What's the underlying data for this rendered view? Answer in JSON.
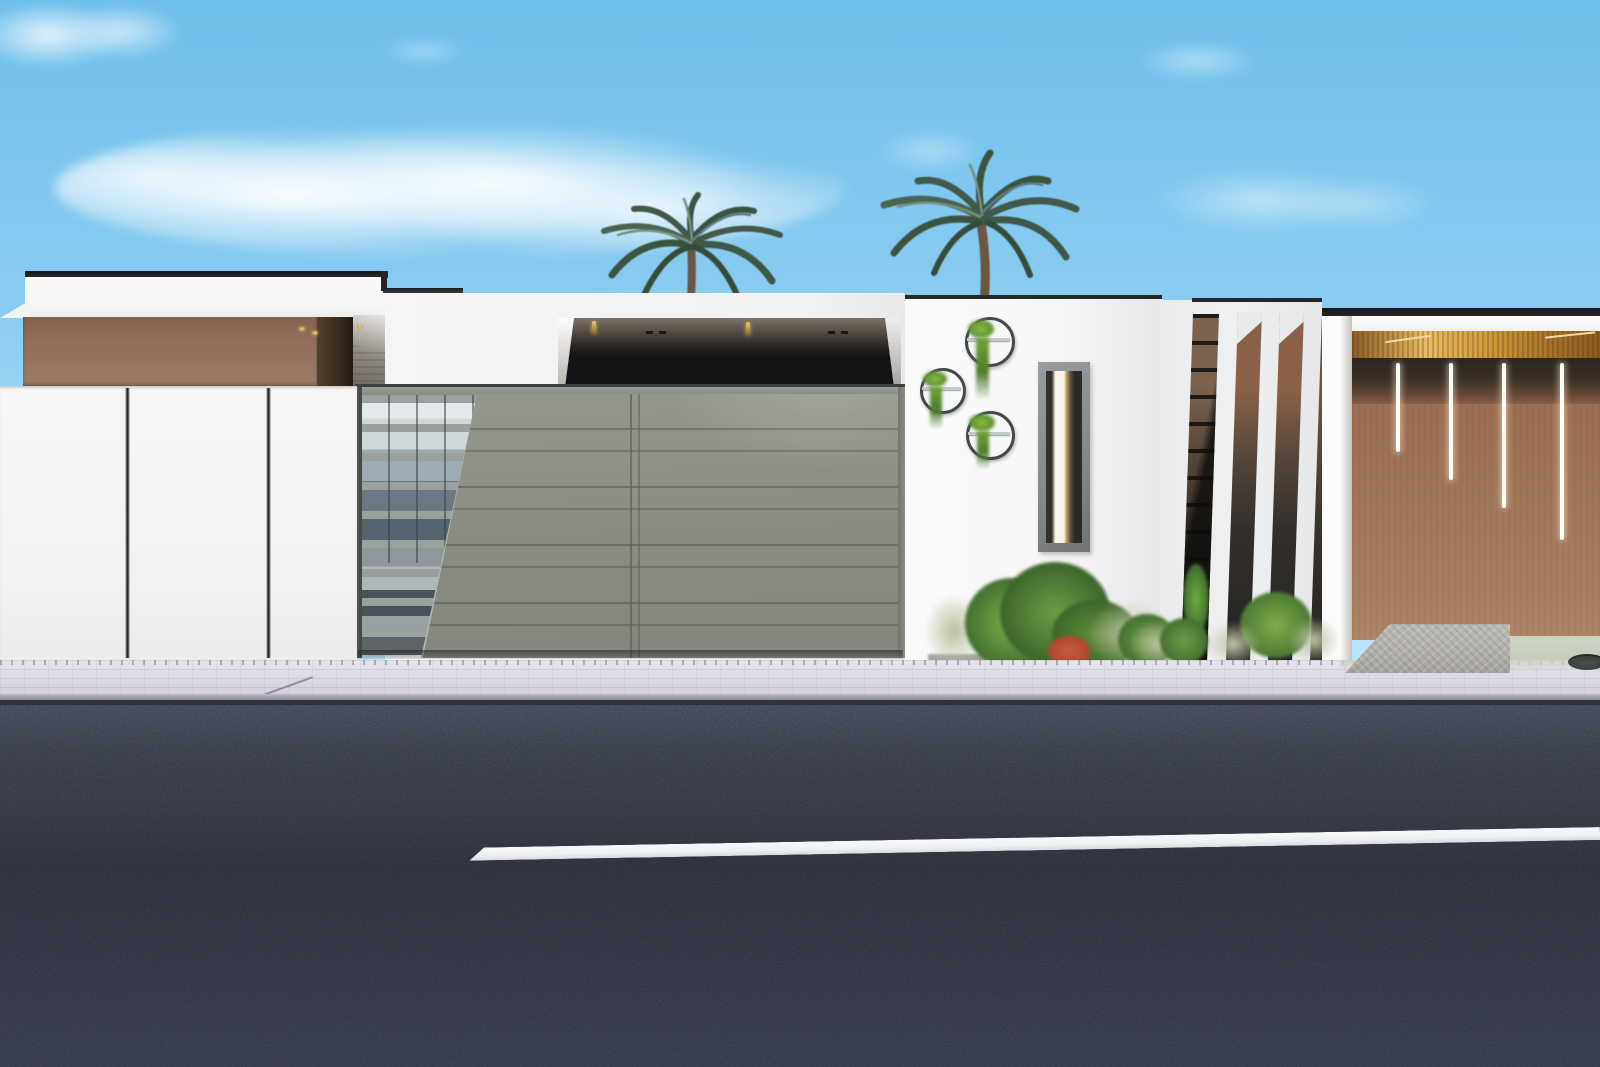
{
  "scene": {
    "description": "Photorealistic architectural rendering: street elevation of a modern flat-roofed villa with gray sliding entrance gates, brown accent walls, wall-mounted circular planters, vertical white fins, two palm trees behind the parapet, paver sidewalk and dark asphalt road with a single white lane line. No text is present in the image.",
    "sky": {
      "top": "#6fbfec",
      "mid": "#8ccdf1",
      "horizon": "#a9ddf6",
      "cloud": "#ffffff",
      "cloud_count": 6
    },
    "left_house": {
      "fascia": "#f5f5f4",
      "coping": "#1e2327",
      "accent_band": "#936f5b",
      "accent_band_light": "#9d7c67",
      "band_side_dark": "#3a2b20",
      "canopy_shadow": "#8d8881",
      "soffit_light": "#e9b64d",
      "soffit_light_count": 5
    },
    "fence": {
      "wall": "#f2f2f4",
      "joint": "#26262a",
      "joint_count": 2
    },
    "garage": {
      "recess_dark": "#121416",
      "soffit": "#6b6159",
      "gold_streak_count": 2,
      "gate": "#8a8e84",
      "gate_light": "#93978c",
      "gate_seam": "#5f6359",
      "gate_rail": "#9aa096",
      "frame": "#434743",
      "glass_slat": "#99a09d",
      "glass_sky_reflection": "#cfd8db",
      "glass_dark_reflection": "#56646f",
      "panel_seam_x2": true
    },
    "planter_wall": {
      "wall": "#f6f6f6",
      "coping": "#23282b",
      "ring": "#424949",
      "plant_light": "#8ab942",
      "plant_dark": "#4e7c2f",
      "planter_count": 3,
      "window_frame": "#83888a",
      "window_dark": "#35302b",
      "window_glow": "#f5f2e8",
      "window_warm": "#c7a66a"
    },
    "fins": {
      "fin_white": "#eff0f2",
      "gap_top_brown": "#8a6148",
      "gap_dark": "#242220",
      "louver_dark": "#17140f",
      "gap_count": 4
    },
    "right_wing": {
      "beam": "#f1f1ef",
      "coping": "#23272a",
      "wood_ceiling": "#cf9b3a",
      "wood_ceiling_bright": "#e7bc63",
      "shadow_band": "#3a2f26",
      "wall_brown": "#9c6e53",
      "wall_brown_light": "#a87e62",
      "led_strip": "#fdfdf8",
      "led_count": 4,
      "ramp_stone": "#b3b1ab",
      "walkway_green": "#c3cabb",
      "utility_disc": "#3c413c"
    },
    "ground": {
      "sidewalk": "#dcdbe4",
      "sidewalk_dark": "#cfced9",
      "sidewalk_joint": "#b7b4c4",
      "curb": "#b9b8c2",
      "road_top": "#50555f",
      "road_mid": "#33373f",
      "road_bottom": "#3d424e",
      "lane_line": "#eef0f3"
    },
    "vegetation": {
      "palm_dark": "#3c5340",
      "palm_mid": "#54735a",
      "palm_light": "#74927c",
      "palm_teal": "#5c7e86",
      "palm_trunk": "#6b5641",
      "palm_cluster_count": 2,
      "shrub_green": "#5d8c3a",
      "shrub_dark": "#3f6b2d",
      "shrub_light": "#7fae4b",
      "shrub_red": "#b0442f",
      "grass_pale": "#b9c09c"
    }
  }
}
